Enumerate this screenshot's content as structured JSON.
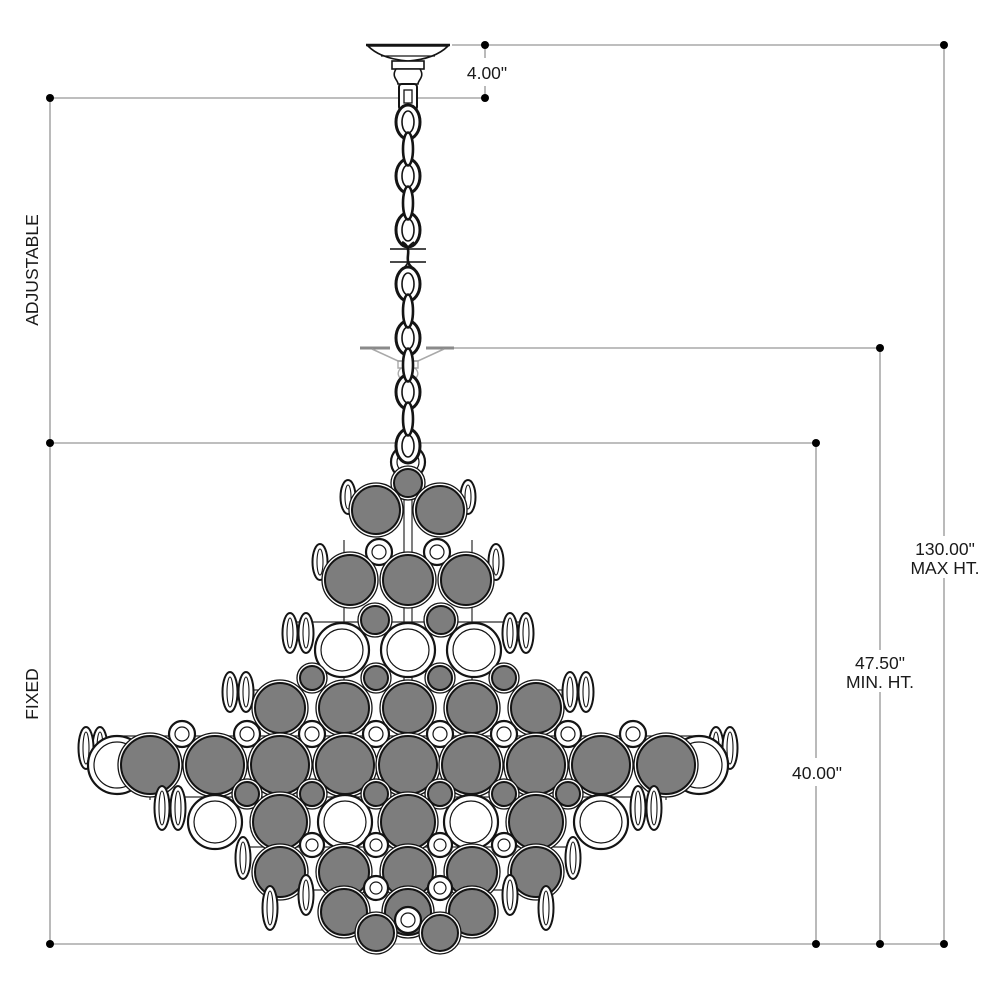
{
  "drawing_title": "chandelier-dimension-diagram",
  "dimensions": {
    "canopy_drop": {
      "label": "4.00\""
    },
    "max_height": {
      "value": "130.00\"",
      "caption": "MAX HT."
    },
    "min_height": {
      "value": "47.50\"",
      "caption": "MIN. HT."
    },
    "fixture_height": {
      "label": "40.00\""
    },
    "adjustable_segment": {
      "label": "ADJUSTABLE"
    },
    "fixed_segment": {
      "label": "FIXED"
    }
  },
  "colors": {
    "background": "#ffffff",
    "dimension_line": "#a8a8a8",
    "marker_dot": "#000000",
    "outline": "#141414",
    "glass_gray": "#7d7d7d",
    "ghost_gray": "#9a9a9a",
    "text": "#1a1a1a"
  }
}
